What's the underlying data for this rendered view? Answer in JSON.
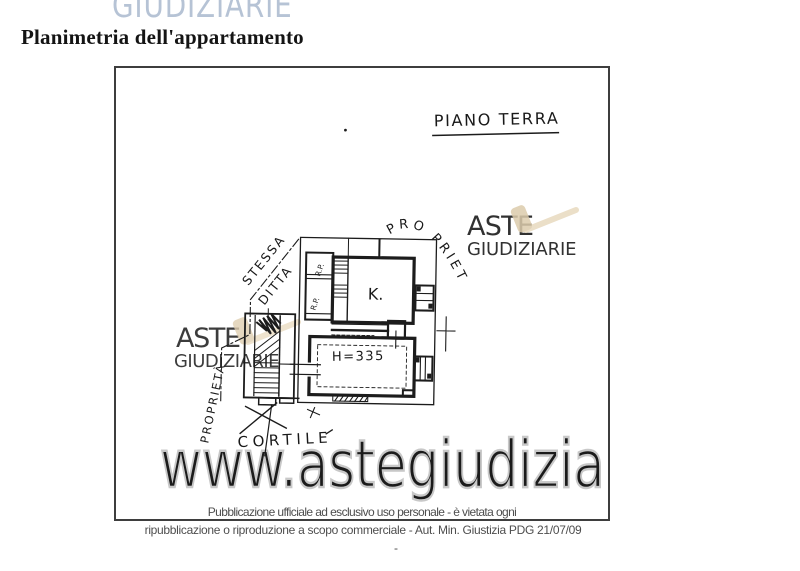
{
  "header": {
    "clipped_watermark": "GIUDIZIARIE",
    "title": "Planimetria dell'appartamento"
  },
  "plan": {
    "floor_label": "PIANO TERRA",
    "room_kitchen": "K.",
    "room_height": "H=335",
    "storage_top": "R.P.",
    "storage_bottom": "R.P.",
    "courtyard": "CORTILE",
    "property_left": "PROPRIETÀ",
    "property_right": "PRO PRIETÀ",
    "same_firm_line1": "STESSA",
    "same_firm_line2": "DITTA"
  },
  "watermark": {
    "brand_name": "ASTE",
    "brand_suffix": "GIUDIZIARIE",
    "site_url": "www.astegiudiziarie.it",
    "brand_color": "#a6b9d0",
    "brand_suffix_color": "#b3c3d6",
    "gavel_color": "#e6d6b8",
    "gavel_head_color": "#d9c6a3",
    "url_outline_color": "#c8c8c8"
  },
  "footer": {
    "line1": "Pubblicazione ufficiale ad esclusivo uso personale - è vietata ogni",
    "line2": "ripubblicazione o riproduzione a scopo commerciale - Aut. Min. Giustizia PDG 21/07/09",
    "dash": "-"
  }
}
